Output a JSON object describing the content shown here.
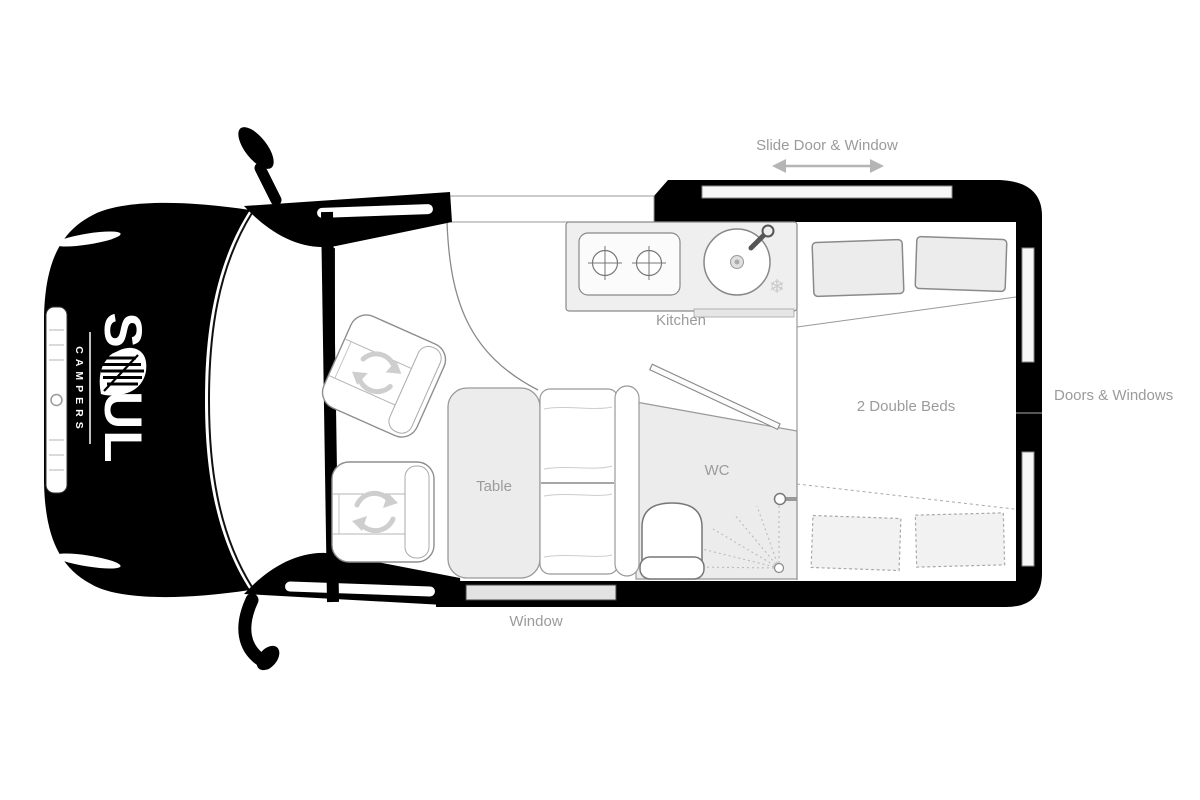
{
  "title": "Soul Campers campervan floor plan",
  "brand": {
    "name": "SOUL",
    "tagline": "CAMPERS"
  },
  "labels": {
    "slide_door_window": "Slide Door & Window",
    "kitchen": "Kitchen",
    "doors_windows": "Doors & Windows",
    "double_beds": "2 Double Beds",
    "table": "Table",
    "wc": "WC",
    "window": "Window"
  },
  "icons": {
    "fridge_snowflake": "❄"
  },
  "colors": {
    "van_body": "#000000",
    "label_text": "#9b9b9b",
    "furniture_fill": "#ececec",
    "furniture_stroke": "#8a8a8a",
    "dashed_stroke": "#aaaaaa",
    "swivel_icon": "#cecece",
    "background": "#ffffff"
  }
}
